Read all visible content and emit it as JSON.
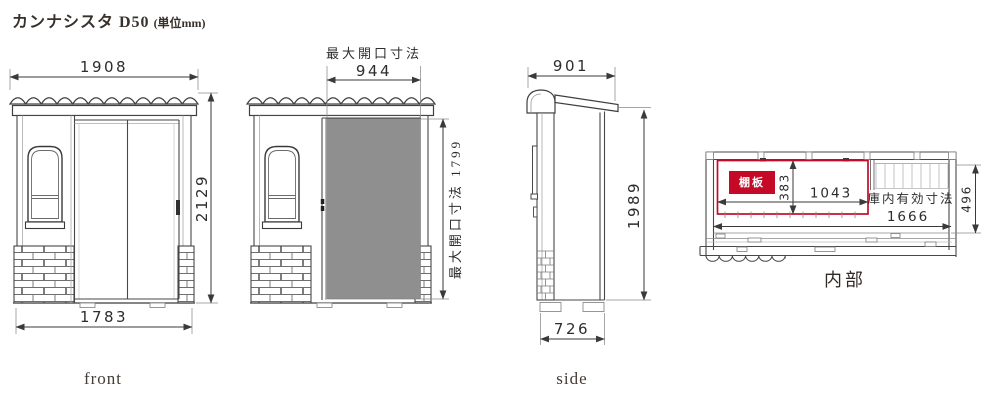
{
  "header": {
    "title": "カンナシスタ D50",
    "unit_note": "(単位mm)"
  },
  "front_view": {
    "label": "front",
    "dim_roof_width": "1908",
    "dim_height": "2129",
    "dim_base_width": "1783"
  },
  "opening_view": {
    "caption": "最大開口寸法",
    "dim_width": "944",
    "dim_height_label": "最大開口寸法 1799"
  },
  "side_view": {
    "label": "side",
    "dim_depth": "901",
    "dim_height": "1989",
    "dim_base_depth": "726"
  },
  "interior_view": {
    "label": "内部",
    "shelf_tag": "棚板",
    "dim_shelf_depth": "383",
    "dim_shelf_width": "1043",
    "inner_caption": "庫内有効寸法",
    "dim_inner_width": "1666",
    "dim_inner_depth": "496"
  },
  "colors": {
    "accent_red": "#c50a28",
    "door_gray": "#8f8f8f",
    "line_dark": "#3f3f3f"
  }
}
